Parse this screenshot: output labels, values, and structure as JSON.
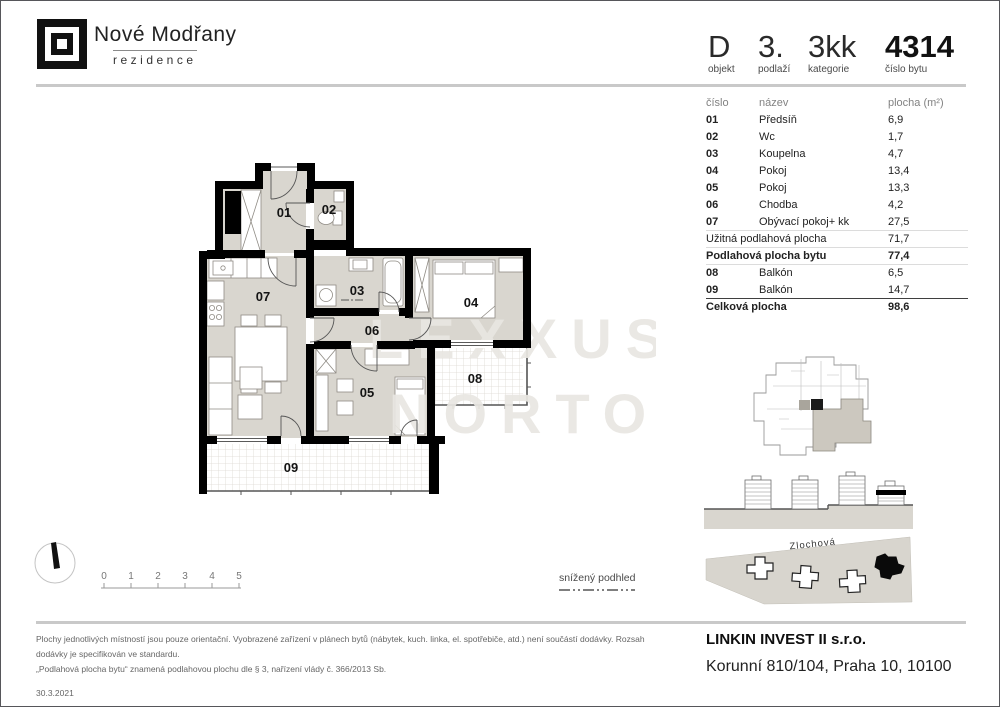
{
  "brand": {
    "name": "Nové Modřany",
    "subtitle": "rezidence"
  },
  "header": {
    "fields": [
      {
        "value": "D",
        "label": "objekt"
      },
      {
        "value": "3.",
        "label": "podlaží"
      },
      {
        "value": "3kk",
        "label": "kategorie"
      },
      {
        "value": "4314",
        "label": "číslo bytu"
      }
    ]
  },
  "table": {
    "col_number": "číslo",
    "col_name": "název",
    "col_area": "plocha (m²)",
    "rows": [
      {
        "number": "01",
        "name": "Předsíň",
        "area": "6,9"
      },
      {
        "number": "02",
        "name": "Wc",
        "area": "1,7"
      },
      {
        "number": "03",
        "name": "Koupelna",
        "area": "4,7"
      },
      {
        "number": "04",
        "name": "Pokoj",
        "area": "13,4"
      },
      {
        "number": "05",
        "name": "Pokoj",
        "area": "13,3"
      },
      {
        "number": "06",
        "name": "Chodba",
        "area": "4,2"
      },
      {
        "number": "07",
        "name": "Obývací pokoj+ kk",
        "area": "27,5"
      }
    ],
    "usable": {
      "label": "Užitná podlahová plocha",
      "value": "71,7"
    },
    "floor_area": {
      "label": "Podlahová plocha bytu",
      "value": "77,4"
    },
    "balcony_rows": [
      {
        "number": "08",
        "name": "Balkón",
        "area": "6,5"
      },
      {
        "number": "09",
        "name": "Balkón",
        "area": "14,7"
      }
    ],
    "total": {
      "label": "Celková plocha",
      "value": "98,6"
    }
  },
  "plan": {
    "rooms": [
      {
        "id": "01"
      },
      {
        "id": "02"
      },
      {
        "id": "03"
      },
      {
        "id": "04"
      },
      {
        "id": "05"
      },
      {
        "id": "06"
      },
      {
        "id": "07"
      },
      {
        "id": "08"
      },
      {
        "id": "09"
      }
    ],
    "watermark_line1": "LEXXUS",
    "watermark_line2": "NORTON",
    "legend": "snížený podhled",
    "scale_labels": [
      "0",
      "1",
      "2",
      "3",
      "4",
      "5"
    ]
  },
  "site": {
    "street": "Zlochová"
  },
  "footer": {
    "disclaimer_line1": "Plochy jednotlivých místností jsou pouze orientační. Vyobrazené zařízení v plánech bytů (nábytek, kuch. linka, el. spotřebiče, atd.) není součástí dodávky. Rozsah dodávky je specifikován ve standardu.",
    "disclaimer_line2": "„Podlahová plocha bytu“ znamená podlahovou plochu dle § 3, nařízení vlády č. 366/2013 Sb.",
    "date": "30.3.2021",
    "company": "LINKIN INVEST II s.r.o.",
    "address": "Korunní 810/104, Praha 10, 10100"
  },
  "colors": {
    "room_fill": "#d9d6cf",
    "wall": "#000000",
    "divider": "#c9c9c9"
  }
}
